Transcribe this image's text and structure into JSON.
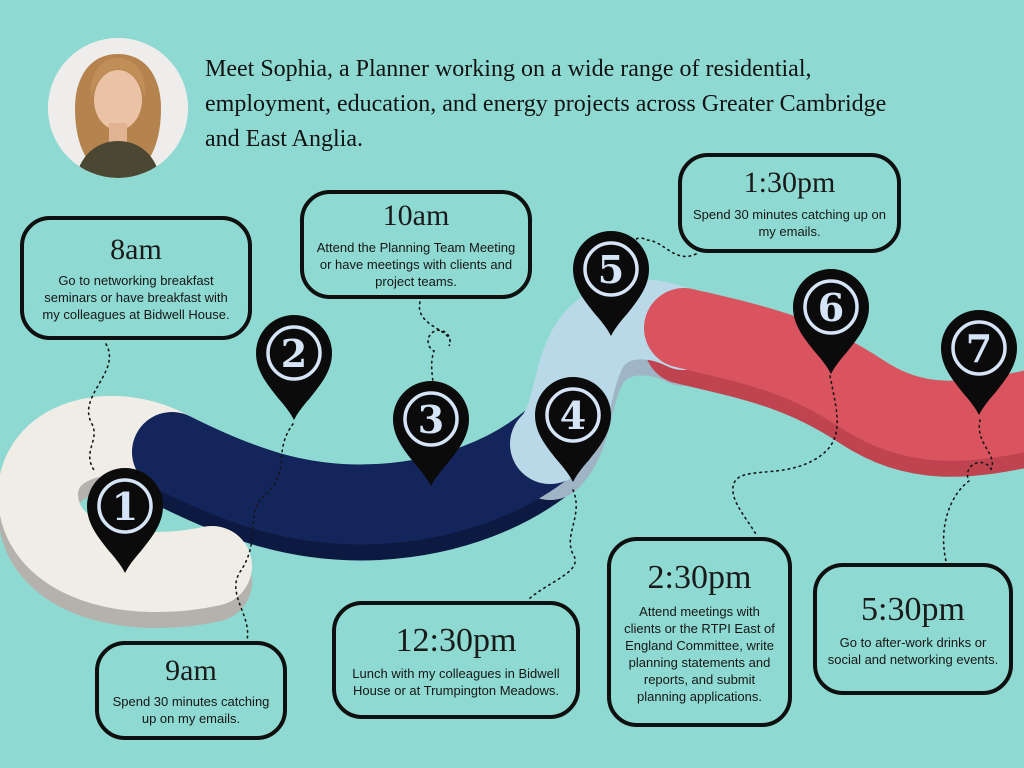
{
  "colors": {
    "background": "#8edad2",
    "ink": "#131313",
    "pin_fill": "#0b0b0b",
    "pin_accent": "#d5e5f7",
    "road_segment_1": "#f0ede7",
    "road_segment_1_side": "#b5b2ae",
    "road_segment_2": "#13255b",
    "road_segment_2_side": "#0c1a42",
    "road_segment_3": "#bad9e8",
    "road_segment_3_side": "#9fb4c4",
    "road_segment_4": "#d9545f",
    "road_segment_4_side": "#bf4450"
  },
  "header": {
    "intro_lines": [
      "Meet Sophia, a Planner working on a wide range of residential,",
      "employment, education, and energy projects across Greater Cambridge",
      "and East Anglia."
    ],
    "avatar_alt": "Portrait photo of Sophia"
  },
  "timeline": {
    "pins": [
      {
        "number": "1"
      },
      {
        "number": "2"
      },
      {
        "number": "3"
      },
      {
        "number": "4"
      },
      {
        "number": "5"
      },
      {
        "number": "6"
      },
      {
        "number": "7"
      }
    ],
    "events": [
      {
        "time": "8am",
        "description": "Go to networking breakfast seminars or have breakfast with my colleagues at Bidwell House."
      },
      {
        "time": "9am",
        "description": "Spend 30 minutes catching up on my emails."
      },
      {
        "time": "10am",
        "description": "Attend the Planning Team Meeting or have meetings with clients and project teams."
      },
      {
        "time": "12:30pm",
        "description": "Lunch with my colleagues in Bidwell House or at Trumpington Meadows."
      },
      {
        "time": "1:30pm",
        "description": "Spend 30 minutes catching up on my emails."
      },
      {
        "time": "2:30pm",
        "description": "Attend meetings with clients or the RTPI East of England Committee, write planning statements and reports, and submit planning applications."
      },
      {
        "time": "5:30pm",
        "description": "Go to after-work drinks or social and networking events."
      }
    ]
  }
}
